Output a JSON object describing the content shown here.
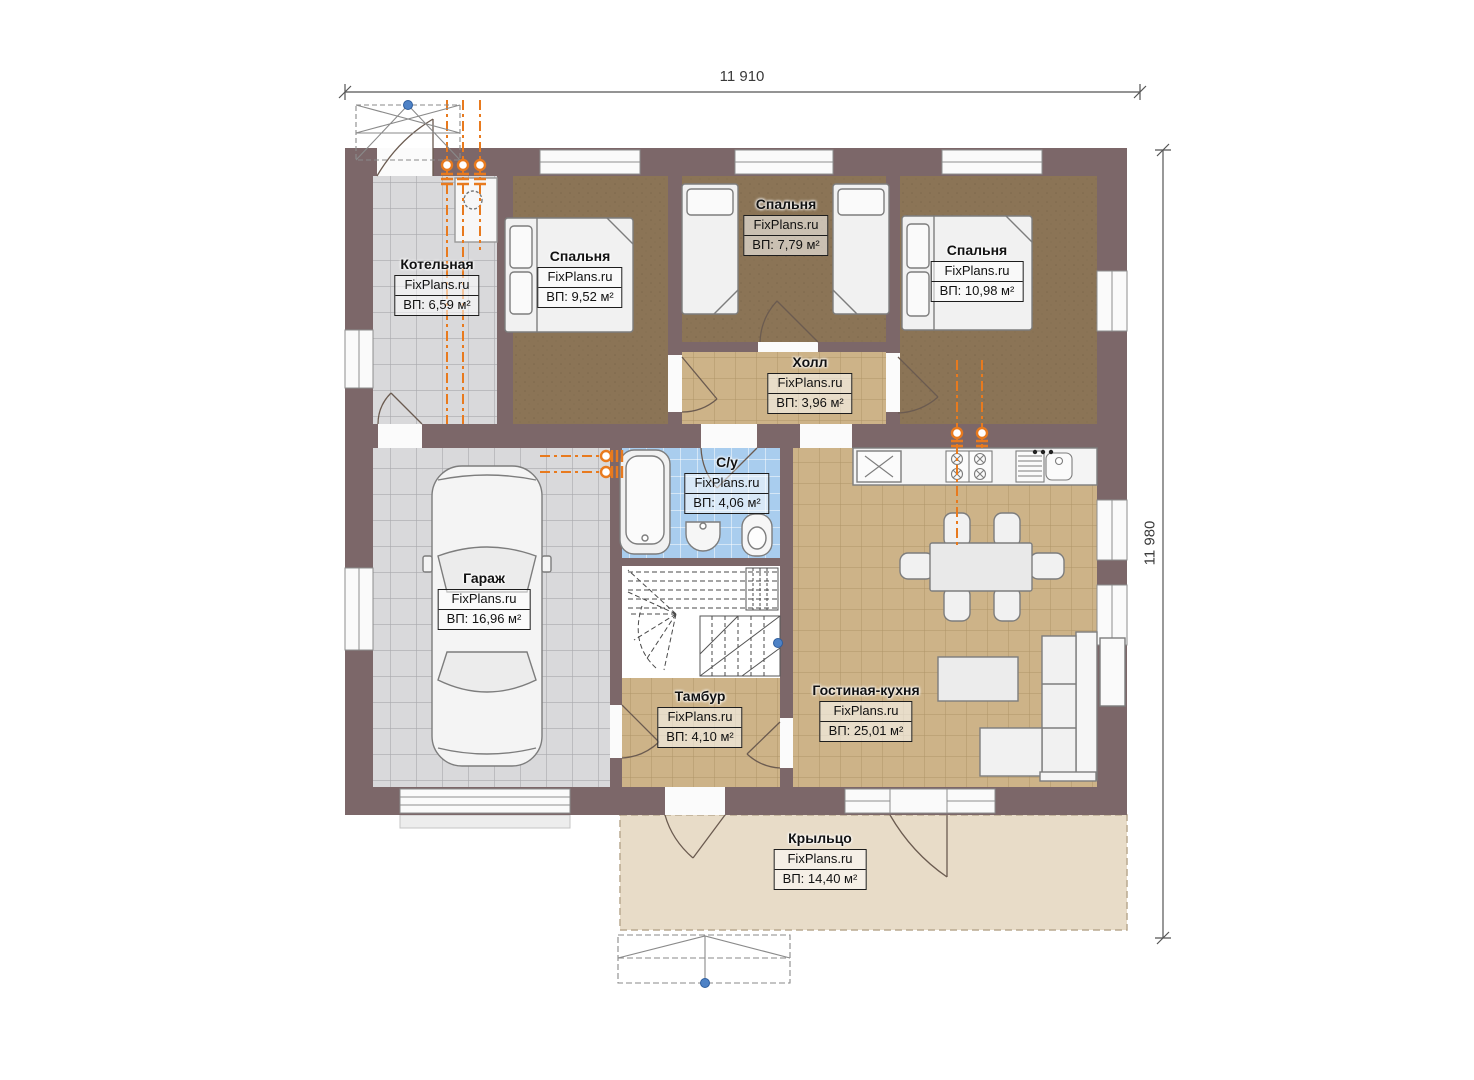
{
  "palette": {
    "paper": "#ffffff",
    "wall": "#7c6769",
    "bedroomFloor": "#8b7456",
    "bedroomSpeck": "#6f5c42",
    "tileGray": "#d9d9db",
    "tileGrayLine": "#a9a9ad",
    "tanFloor": "#cdb388",
    "tanLine": "#ae9468",
    "blueFloor": "#a9cdee",
    "blueLine": "#ffffff",
    "porch": "#e8dcc8",
    "porchEdge": "#b9a98f",
    "furniture": "#f1f1f1",
    "outline": "#7d7d7d",
    "accent": "#e87a1e",
    "marker": "#4e82c6",
    "dim": "#555555"
  },
  "dimensions": {
    "top": "11 910",
    "right": "11 980"
  },
  "rooms": [
    {
      "key": "kotelnaya",
      "name": "Котельная",
      "brand": "FixPlans.ru",
      "area": "ВП: 6,59 м²"
    },
    {
      "key": "bedroom1",
      "name": "Спальня",
      "brand": "FixPlans.ru",
      "area": "ВП: 9,52 м²"
    },
    {
      "key": "bedroom2",
      "name": "Спальня",
      "brand": "FixPlans.ru",
      "area": "ВП: 7,79 м²"
    },
    {
      "key": "bedroom3",
      "name": "Спальня",
      "brand": "FixPlans.ru",
      "area": "ВП: 10,98 м²"
    },
    {
      "key": "hall",
      "name": "Холл",
      "brand": "FixPlans.ru",
      "area": "ВП: 3,96 м²"
    },
    {
      "key": "su",
      "name": "С/у",
      "brand": "FixPlans.ru",
      "area": "ВП: 4,06 м²"
    },
    {
      "key": "garage",
      "name": "Гараж",
      "brand": "FixPlans.ru",
      "area": "ВП: 16,96 м²"
    },
    {
      "key": "tambur",
      "name": "Тамбур",
      "brand": "FixPlans.ru",
      "area": "ВП: 4,10 м²"
    },
    {
      "key": "living",
      "name": "Гостиная-кухня",
      "brand": "FixPlans.ru",
      "area": "ВП: 25,01 м²"
    },
    {
      "key": "porch",
      "name": "Крыльцо",
      "brand": "FixPlans.ru",
      "area": "ВП: 14,40 м²"
    }
  ]
}
